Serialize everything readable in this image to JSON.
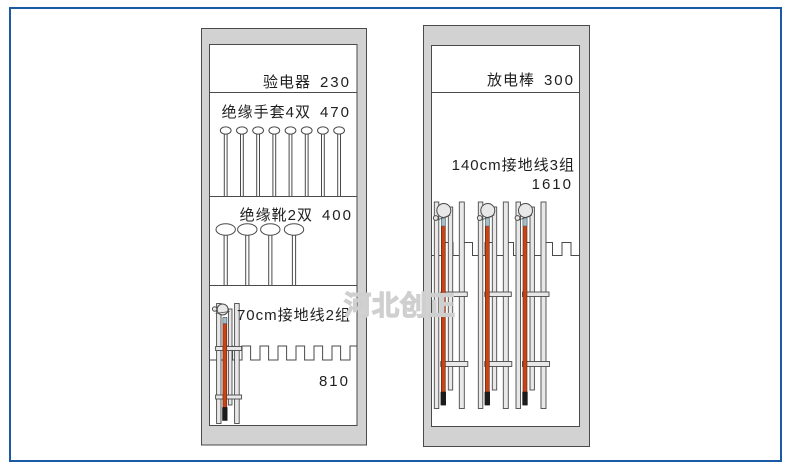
{
  "watermark": {
    "text": "河北创正"
  },
  "colors": {
    "frame_color": "#1b5ba6",
    "cabinet_fill": "#d2d2d2",
    "rail_fill": "#e8e8e8",
    "line": "#4a4a4a",
    "rod_red": "#c84315",
    "rod_tip": "#1c1c1c",
    "rod_collar": "#a4bfc9",
    "watermark_color": "#cfcfcf",
    "text_color": "#1f1f1f"
  },
  "left_cabinet": {
    "sections": [
      {
        "label": "验电器",
        "value": "230"
      },
      {
        "label": "绝缘手套4双",
        "value": "470",
        "hanger_count": 8
      },
      {
        "label": "绝缘靴2双",
        "value": "400",
        "hanger_count": 4
      },
      {
        "label": "70cm接地线2组",
        "value": "810",
        "assembly_count": 1
      }
    ]
  },
  "right_cabinet": {
    "sections": [
      {
        "label": "放电棒",
        "value": "300"
      },
      {
        "label": "140cm接地线3组",
        "value": "1610",
        "assembly_count": 3
      }
    ]
  }
}
